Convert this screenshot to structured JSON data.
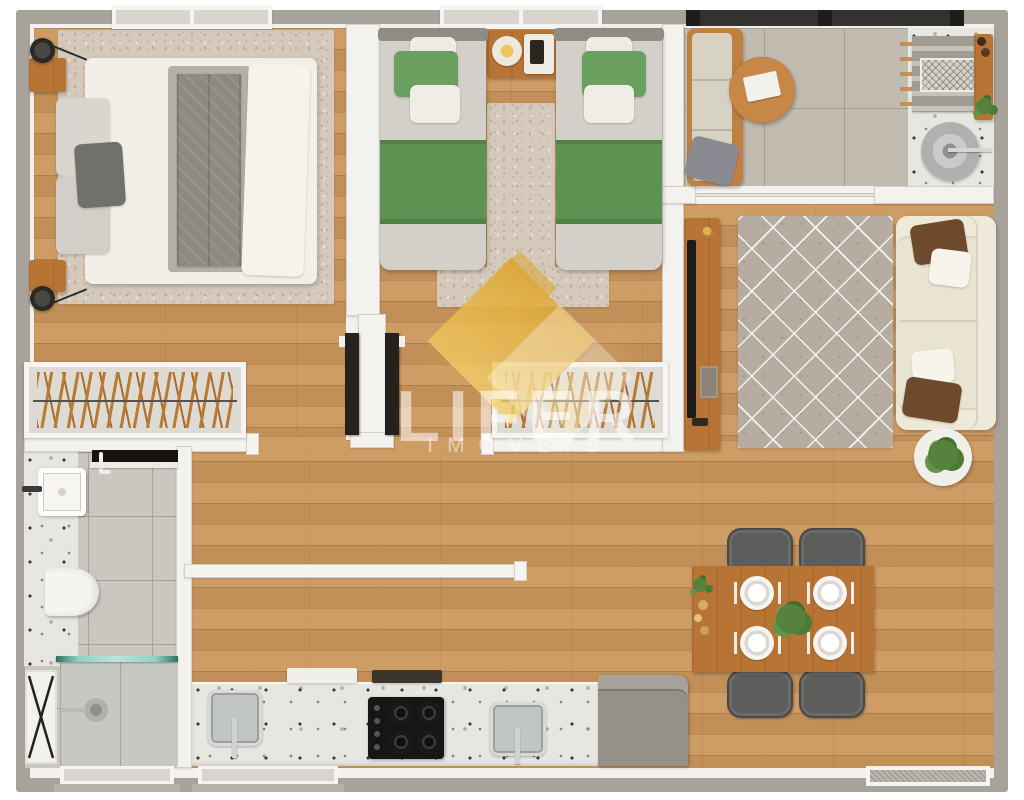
{
  "watermark": {
    "brand": "LIFER",
    "tagline": "IMÓVEIS"
  },
  "palette": {
    "wood_floor": "#cb975c",
    "exterior_wall": "#a7a29a",
    "wall_lining": "#f4f2ee",
    "watermark_gold": "#dca32d",
    "bedding_green": "#69a05f",
    "sofa_cream": "#e9e3d2",
    "wood_furniture": "#b87434",
    "bedroom_rug": "#d4c9ba",
    "balcony_tile": "#c2bbb0",
    "terrazzo": "#e8e6e0",
    "accent_pillow_brown": "#6e4a2c",
    "appliance_black": "#161616"
  },
  "floorplan": {
    "type": "apartment-top-view-3d-render",
    "rooms": [
      {
        "id": "bedroom-double",
        "furniture": [
          "double-bed",
          "gray-throw-blanket",
          "area-rug",
          "nightstand-top",
          "nightstand-bottom",
          "wall-lamp-top",
          "wall-lamp-bottom",
          "open-wardrobe-with-hangers",
          "open-door",
          "window"
        ]
      },
      {
        "id": "bedroom-twin",
        "furniture": [
          "twin-bed-left",
          "twin-bed-right",
          "shared-nightstand",
          "table-lamp",
          "area-rug",
          "open-wardrobe-with-hangers",
          "open-door",
          "windows"
        ]
      },
      {
        "id": "balcony-service",
        "furniture": [
          "bench-seat",
          "round-coffee-table",
          "glass-guardrail",
          "drying-rack",
          "service-counter",
          "laundry-tub",
          "potted-plant"
        ]
      },
      {
        "id": "living-room",
        "furniture": [
          "tv-sideboard",
          "tv",
          "diamond-pattern-rug",
          "sofa",
          "throw-pillows",
          "potted-plant",
          "sliding-door"
        ]
      },
      {
        "id": "dining-area",
        "furniture": [
          "dining-table",
          "place-settings",
          "centerpiece-plant",
          "dining-chairs",
          "window"
        ]
      },
      {
        "id": "kitchen",
        "furniture": [
          "terrazzo-countertop",
          "sink-left",
          "gas-cooktop",
          "sink-right",
          "refrigerator",
          "cutting-boards",
          "window"
        ]
      },
      {
        "id": "bathroom",
        "furniture": [
          "washbasin",
          "faucet",
          "wall-hung-toilet",
          "shower-glass-partition",
          "shower-drain",
          "dark-door-leaf",
          "x-frame-shelf",
          "window"
        ]
      },
      {
        "id": "hallway",
        "furniture": []
      }
    ]
  }
}
